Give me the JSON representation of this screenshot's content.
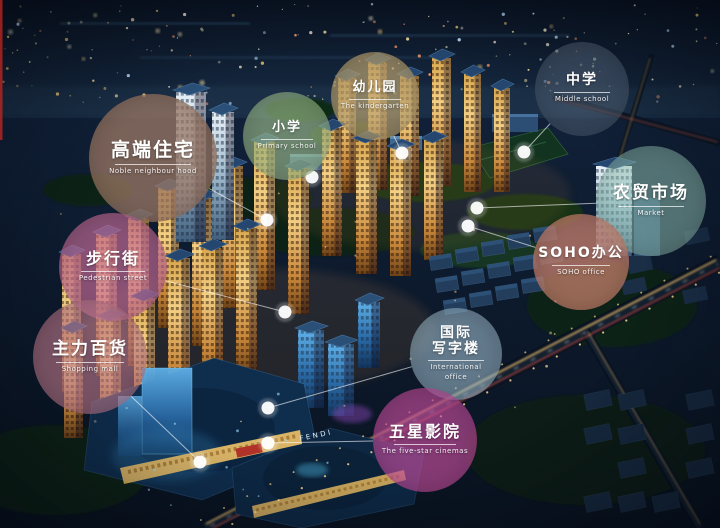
{
  "scene": {
    "signs": [
      {
        "text": "FENDI"
      }
    ]
  },
  "labels": [
    {
      "id": "noble-neighbourhood",
      "cn_lines": [
        "高端住宅"
      ],
      "en_lines": [
        "Noble neighbour hood"
      ],
      "color": "rgba(158,121,101,0.74)",
      "cx": 153,
      "cy": 158,
      "r": 64,
      "dot": [
        267,
        220
      ]
    },
    {
      "id": "pedestrian-street",
      "cn_lines": [
        "步行街"
      ],
      "en_lines": [
        "Pedestrian street"
      ],
      "color": "rgba(201,109,154,0.66)",
      "cx": 113,
      "cy": 267,
      "r": 54,
      "dot": [
        285,
        312
      ]
    },
    {
      "id": "shopping-mall",
      "cn_lines": [
        "主力百货"
      ],
      "en_lines": [
        "Shopping mall"
      ],
      "color": "rgba(193,124,142,0.60)",
      "cx": 90,
      "cy": 357,
      "r": 57,
      "dot": [
        200,
        462
      ]
    },
    {
      "id": "primary-school",
      "cn_lines": [
        "小学"
      ],
      "en_lines": [
        "Primary school"
      ],
      "color": "rgba(163,196,143,0.62)",
      "cx": 287,
      "cy": 136,
      "r": 44,
      "dot": [
        312,
        177
      ]
    },
    {
      "id": "kindergarten",
      "cn_lines": [
        "幼儿园"
      ],
      "en_lines": [
        "The kindergarten"
      ],
      "color": "rgba(187,162,112,0.70)",
      "cx": 375,
      "cy": 96,
      "r": 44,
      "dot": [
        402,
        153
      ]
    },
    {
      "id": "middle-school",
      "cn_lines": [
        "中学"
      ],
      "en_lines": [
        "Middle school"
      ],
      "color": "rgba(80,96,116,0.55)",
      "cx": 582,
      "cy": 89,
      "r": 47,
      "dot": [
        524,
        152
      ]
    },
    {
      "id": "farmers-market",
      "cn_lines": [
        "农贸市场"
      ],
      "en_lines": [
        "Market"
      ],
      "color": "rgba(152,200,184,0.50)",
      "cx": 651,
      "cy": 201,
      "r": 55,
      "dot": [
        477,
        208
      ]
    },
    {
      "id": "soho-office",
      "cn_lines": [
        "SOHO办公"
      ],
      "en_lines": [
        "SOHO office"
      ],
      "color": "rgba(208,133,112,0.72)",
      "cx": 581,
      "cy": 262,
      "r": 48,
      "dot": [
        468,
        226
      ]
    },
    {
      "id": "international-office",
      "cn_lines": [
        "国际",
        "写字楼"
      ],
      "en_lines": [
        "International",
        "office"
      ],
      "color": "rgba(170,203,221,0.55)",
      "cx": 456,
      "cy": 354,
      "r": 46,
      "dot": [
        268,
        408
      ]
    },
    {
      "id": "five-star-cinema",
      "cn_lines": [
        "五星影院"
      ],
      "en_lines": [
        "The five-star cinemas"
      ],
      "color": "rgba(197,78,158,0.66)",
      "cx": 425,
      "cy": 440,
      "r": 52,
      "dot": [
        268,
        443
      ]
    }
  ]
}
